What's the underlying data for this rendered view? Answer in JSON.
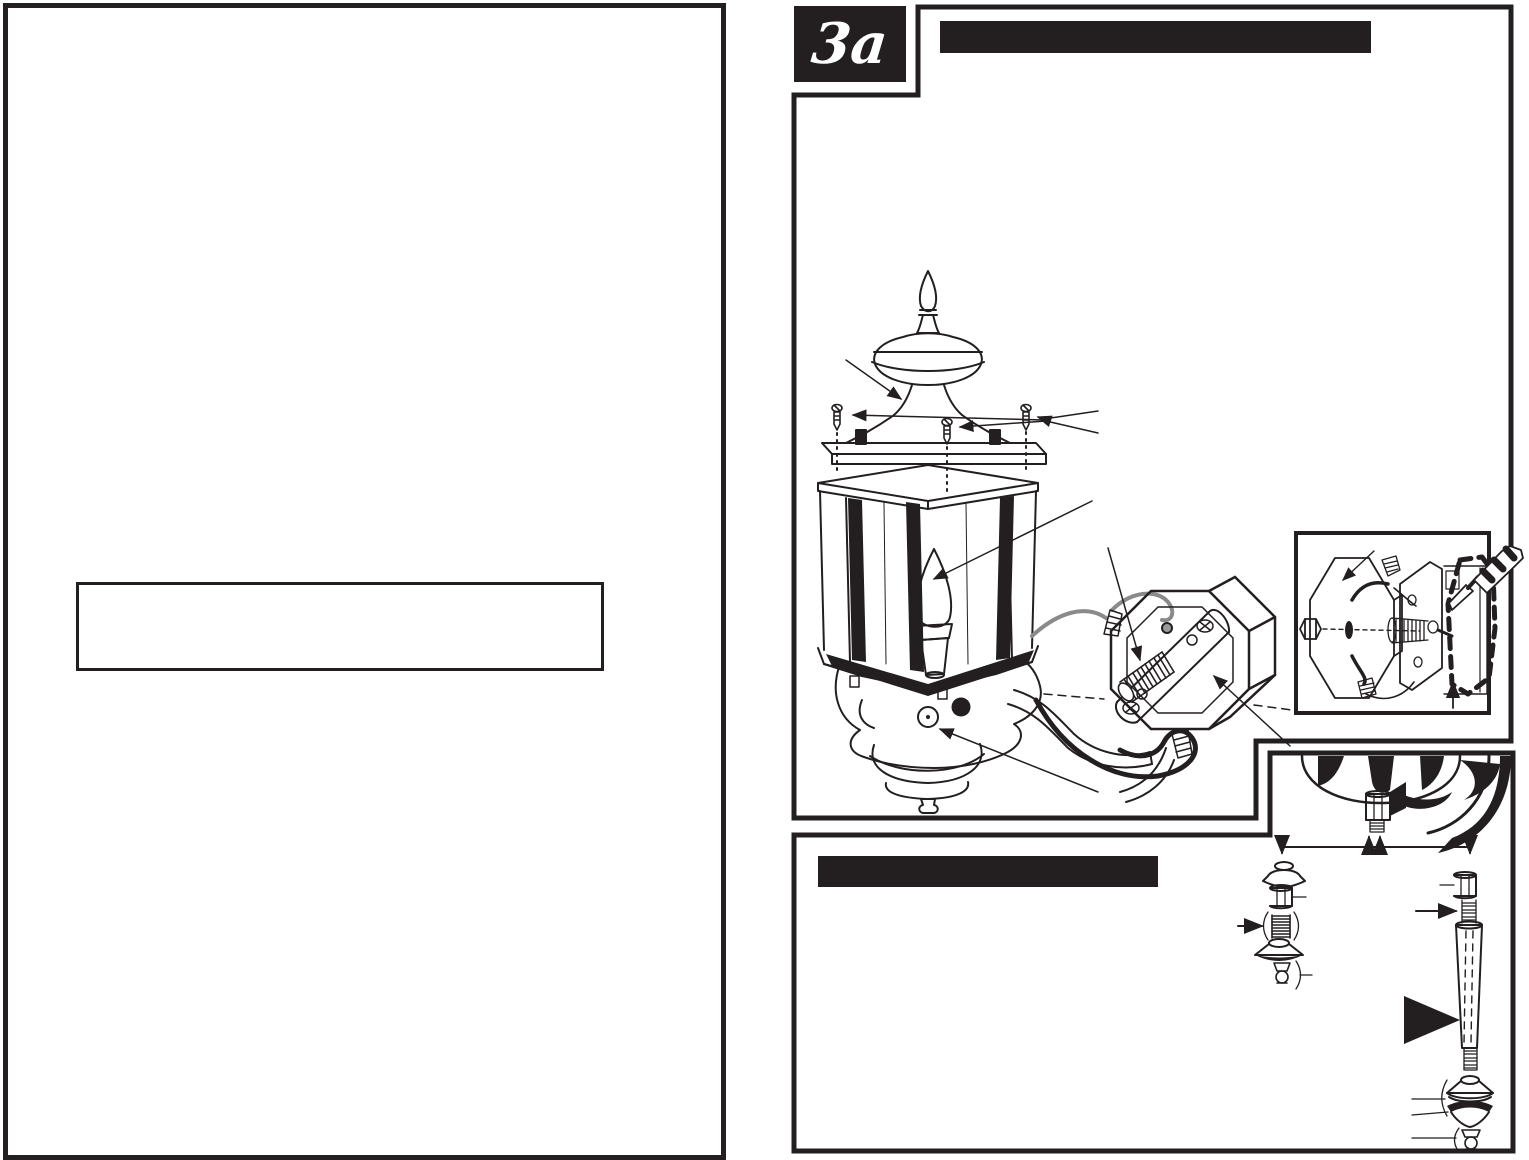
{
  "page": {
    "paper_color": "#ffffff",
    "ink_color": "#231f20"
  },
  "step_badge": {
    "label": "3a"
  },
  "illustration": {
    "main_parts": [
      "finial-icon",
      "cap-icon",
      "cap-screws-icon",
      "lantern-body-icon",
      "candelabra-bulb-icon",
      "photocell-sensor-icon",
      "lantern-base-icon",
      "mounting-arm-icon",
      "octagon-wall-plate-icon",
      "crossbar-icon",
      "threaded-nipple-icon",
      "wire-nut-icon",
      "wires-icon"
    ],
    "inset_parts": [
      "wall-plate-icon",
      "hex-nut-icon",
      "threaded-nipple-icon",
      "crossbar-icon",
      "recessed-junction-box-icon",
      "screwdriver-icon",
      "wire-nut-icon"
    ],
    "stem_parts": [
      "lantern-bottom-closeup-icon",
      "hex-stem-icon",
      "threaded-stud-icon",
      "canopy-cap-icon",
      "coupling-nut-icon",
      "coil-nipple-icon",
      "cone-washer-icon",
      "small-finial-icon",
      "extension-rod-icon"
    ]
  }
}
